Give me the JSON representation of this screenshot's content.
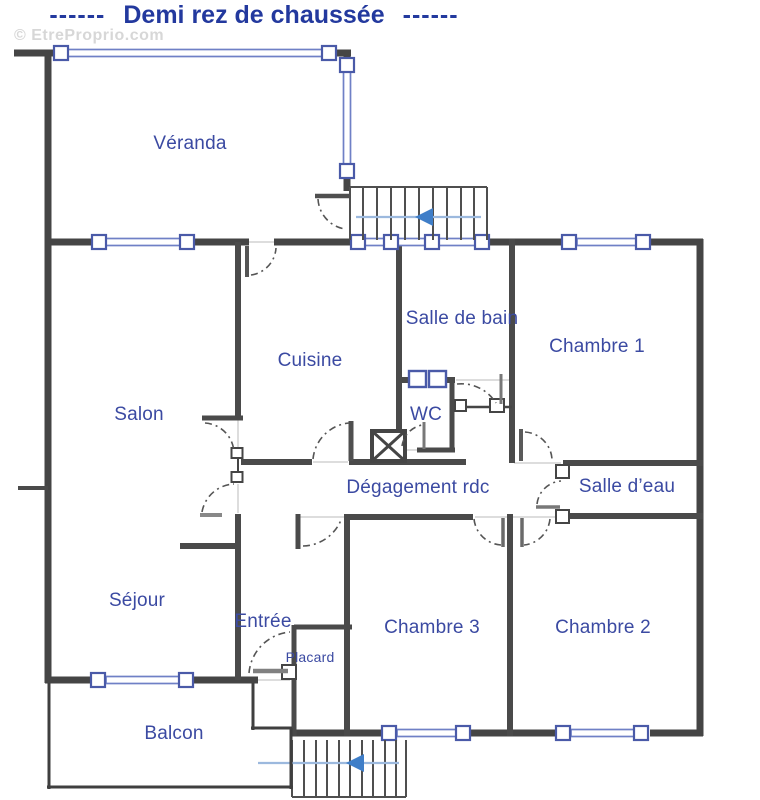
{
  "title": {
    "left_dashes": "------",
    "text": "Demi rez de chaussée",
    "right_dashes": "------"
  },
  "watermark": {
    "text": "© EtreProprio.com"
  },
  "plan": {
    "type": "floor-plan",
    "floor_name": "Demi rez de chaussée"
  },
  "rooms": [
    {
      "label": "Véranda"
    },
    {
      "label": "Cuisine"
    },
    {
      "label": "Salle de bain"
    },
    {
      "label": "Chambre 1"
    },
    {
      "label": "Salon"
    },
    {
      "label": "WC"
    },
    {
      "label": "Dégagement rdc"
    },
    {
      "label": "Salle d’eau"
    },
    {
      "label": "Séjour"
    },
    {
      "label": "Entrée"
    },
    {
      "label": "Placard"
    },
    {
      "label": "Chambre 3"
    },
    {
      "label": "Chambre 2"
    },
    {
      "label": "Balcon"
    }
  ],
  "colors": {
    "title_blue": "#23399e",
    "label_blue": "#3b4aa2",
    "wall_gray": "#454545",
    "window_frame_blue": "#4a5aa8",
    "window_glass_blue": "#6f80c6",
    "stair_arrow_blue": "#3f7ec8",
    "watermark_gray": "#d7d7d7"
  }
}
